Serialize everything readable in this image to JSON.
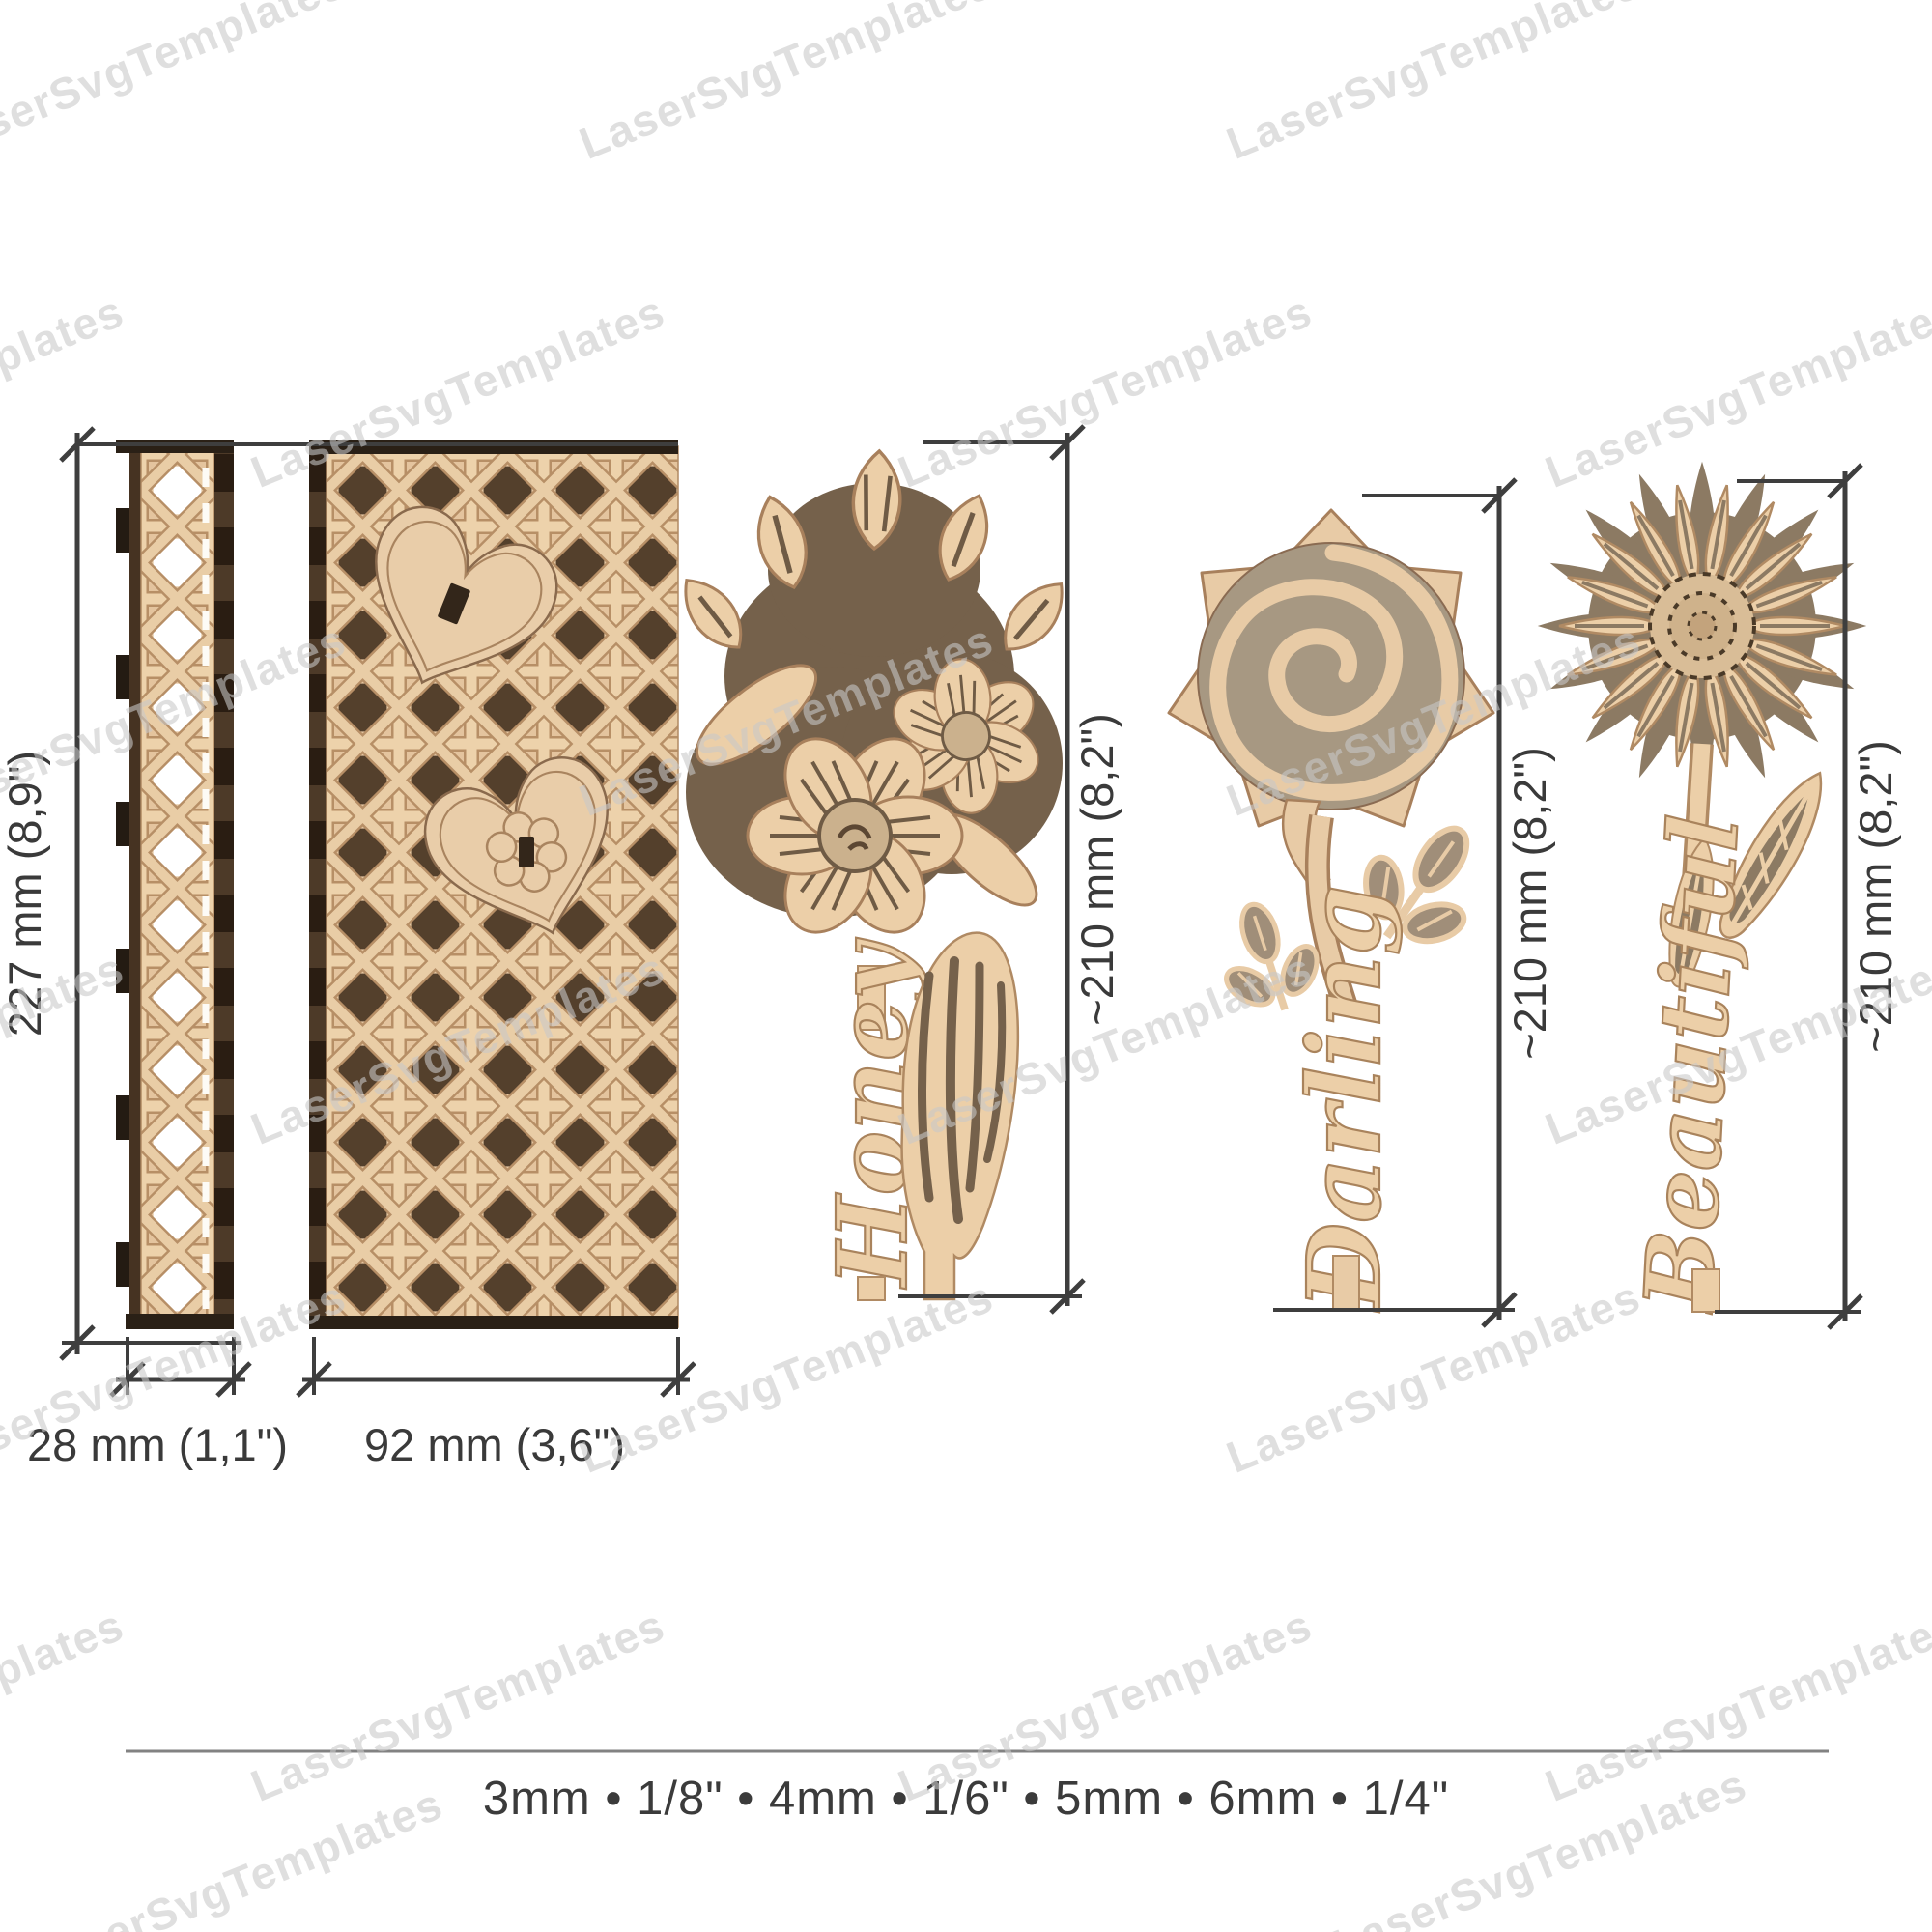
{
  "watermark": {
    "text": "LaserSvgTemplates",
    "color": "#cfcfcf",
    "angle_deg": -22,
    "positions": [
      [
        150,
        80
      ],
      [
        820,
        80
      ],
      [
        1490,
        80
      ],
      [
        -80,
        420
      ],
      [
        480,
        420
      ],
      [
        1150,
        420
      ],
      [
        1820,
        420
      ],
      [
        150,
        760
      ],
      [
        820,
        760
      ],
      [
        1490,
        760
      ],
      [
        -80,
        1100
      ],
      [
        480,
        1100
      ],
      [
        1150,
        1100
      ],
      [
        1820,
        1100
      ],
      [
        150,
        1440
      ],
      [
        820,
        1440
      ],
      [
        1490,
        1440
      ],
      [
        -80,
        1780
      ],
      [
        480,
        1780
      ],
      [
        1150,
        1780
      ],
      [
        1820,
        1780
      ],
      [
        250,
        1965
      ],
      [
        1600,
        1945
      ]
    ]
  },
  "panels": {
    "height_label": "227 mm (8,9\")",
    "narrow": {
      "name": "cane strip panel",
      "width_label": "28 mm (1,1\")"
    },
    "wide": {
      "name": "cane heart panel",
      "width_label": "92 mm (3,6\")"
    }
  },
  "flowers": [
    {
      "name": "daffodil-bouquet",
      "stem_word": "Honey",
      "height_label": "~210 mm (8,2\")"
    },
    {
      "name": "rose",
      "stem_word": "Darling",
      "height_label": "~210 mm (8,2\")"
    },
    {
      "name": "daisy",
      "stem_word": "Beautiful",
      "height_label": "~210 mm (8,2\")"
    }
  ],
  "caption": "3mm • 1/8\" • 4mm • 1/6\" • 5mm • 6mm • 1/4\"",
  "colors": {
    "wood_light": "#eccfa8",
    "wood_base": "#e4c49e",
    "weave_highlight": "#edd2ab",
    "weave_outline": "#b78f66",
    "hole_dark": "#54402c",
    "edge_dark": "#2a1d12",
    "backing_taupe": "#a79882",
    "backing_brown": "#75614b",
    "backing_olive": "#8c7a63",
    "dimension_line": "#3e3e3e",
    "label_text": "#3a3a3a",
    "watermark_gray": "#cfcfcf"
  }
}
